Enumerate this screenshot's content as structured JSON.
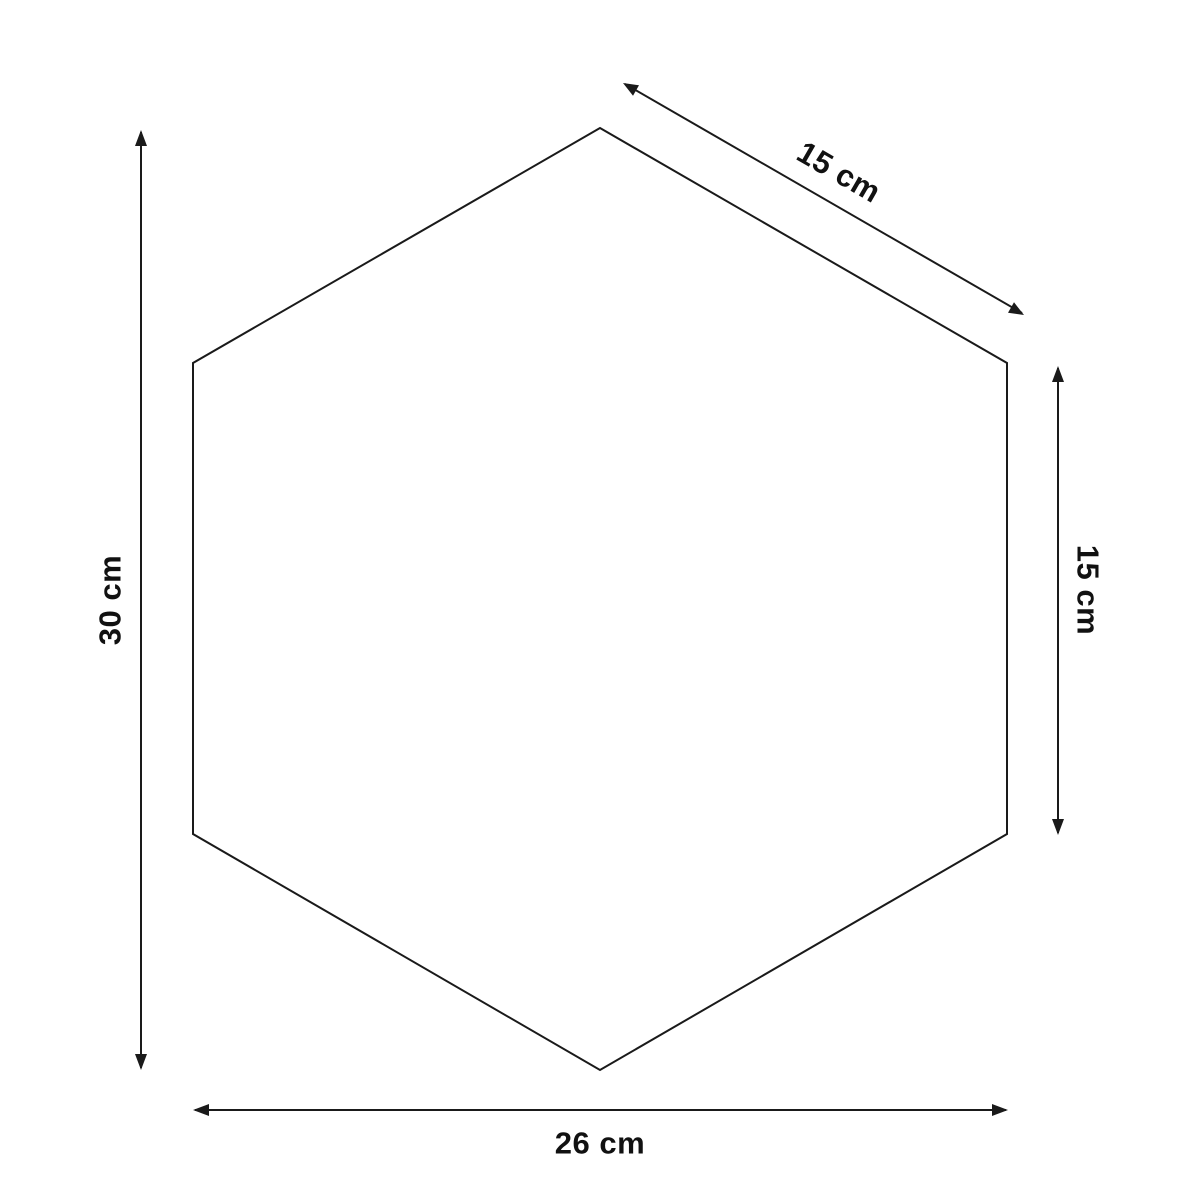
{
  "page": {
    "background_color": "#ffffff",
    "stroke_color": "#1a1a1a"
  },
  "diagram": {
    "shape": "hexagon",
    "description_labels_count": 4
  },
  "dimensions": {
    "height": {
      "label": "30 cm",
      "value": 30,
      "unit": "cm"
    },
    "top_right_side": {
      "label": "15 cm",
      "value": 15,
      "unit": "cm"
    },
    "right_side": {
      "label": "15 cm",
      "value": 15,
      "unit": "cm"
    },
    "width": {
      "label": "26 cm",
      "value": 26,
      "unit": "cm"
    }
  }
}
